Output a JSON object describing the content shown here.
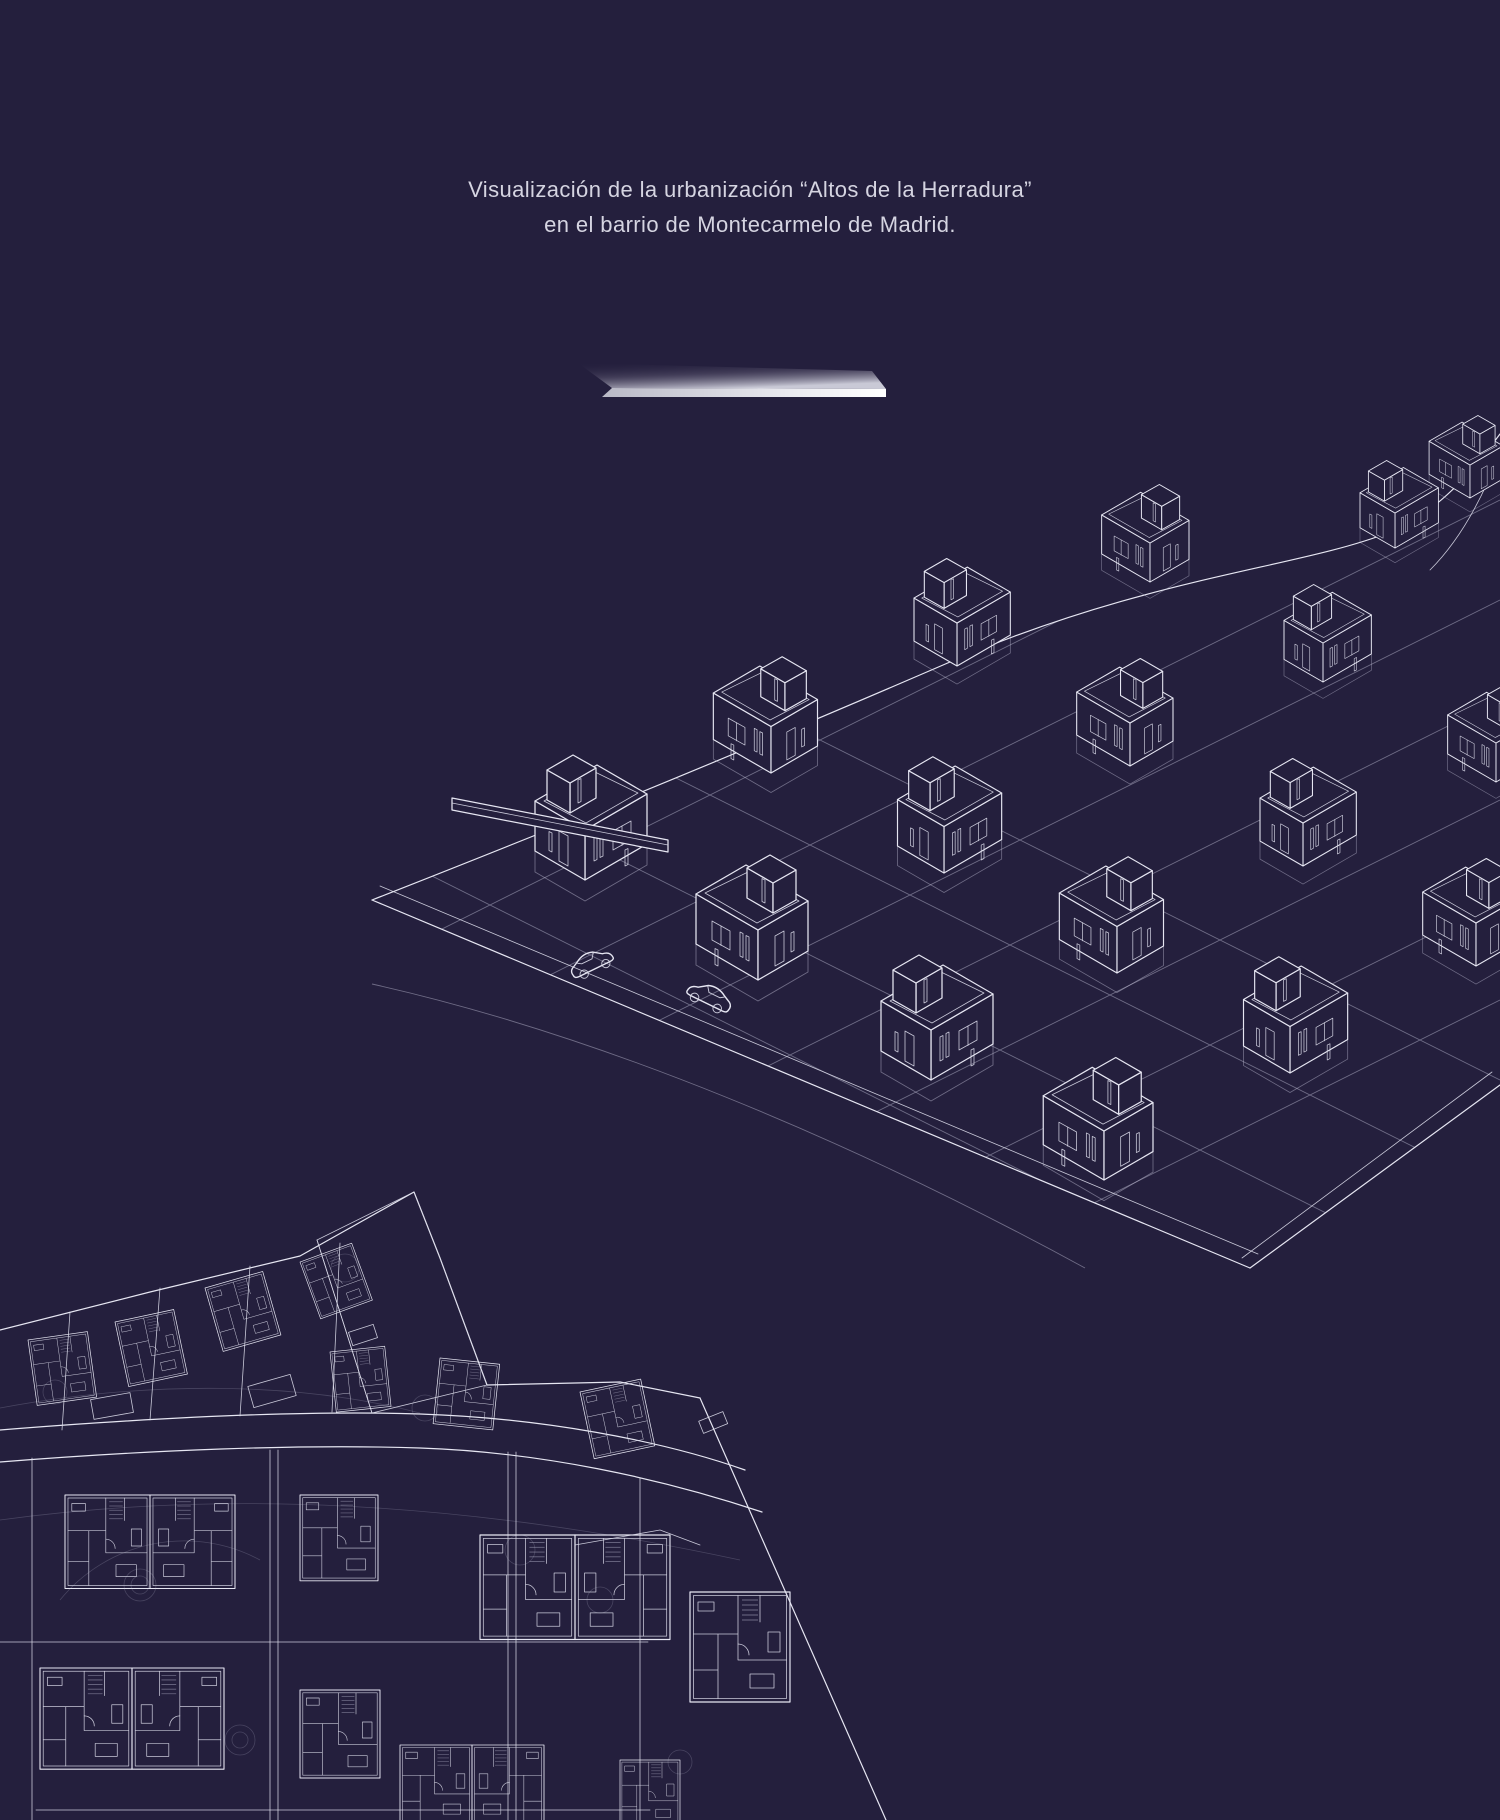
{
  "caption": {
    "line1": "Visualización de la urbanización “Altos de la Herradura”",
    "line2": "en el barrio de Montecarmelo de Madrid."
  },
  "theme": {
    "background": "#241f3d",
    "wireframe_line": "#e6e6f2",
    "text_color": "#d5d4e1",
    "blade_highlight": "#f4f4f8"
  },
  "illustrations": {
    "blade": "metallic-blade-divider",
    "axonometric": "wireframe-axonometric-view-of-housing-development",
    "site_plan": "blueprint-site-plan-of-housing-development"
  }
}
